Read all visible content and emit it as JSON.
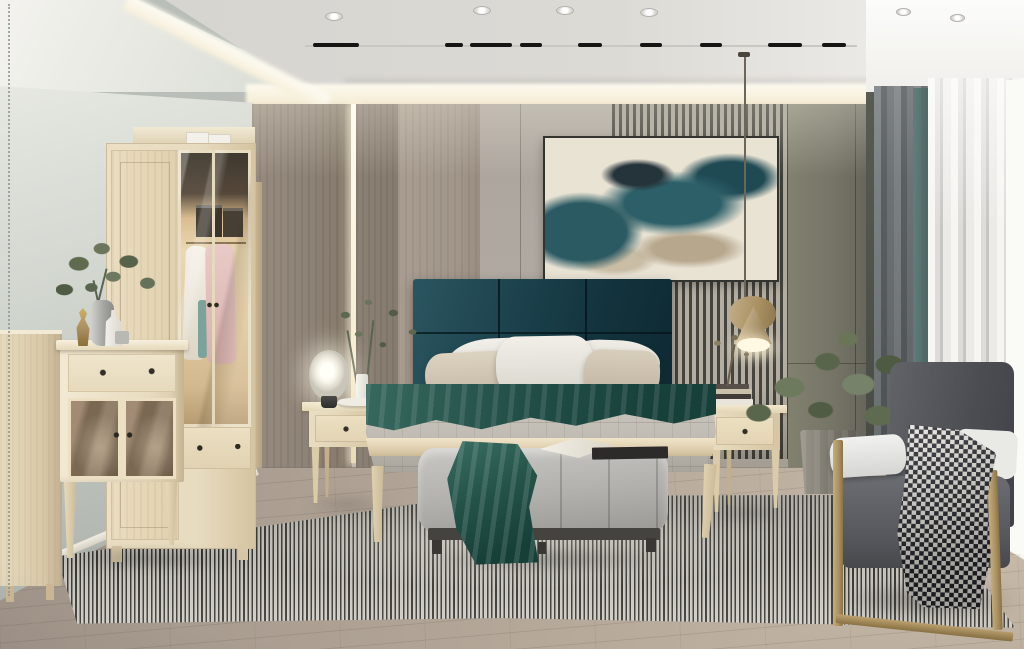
{
  "scene": {
    "type": "photorealistic interior render",
    "room": "bedroom",
    "style": "modern light-wood scandinavian",
    "objects": [
      "wardrobe-with-glass-display",
      "storage-boxes",
      "dresser-with-mirrored-doors",
      "sideboard",
      "plant-vase-decor",
      "upholstered-headboard-panels",
      "double-bed-light-wood",
      "pillows",
      "teal-throw-blanket",
      "nightstand-left",
      "nightstand-right",
      "glass-table-lamp",
      "gold-cone-pendant-lamp",
      "abstract-wall-art",
      "slatted-wall-panel",
      "led-wall-strip",
      "upholstered-bench",
      "open-book",
      "striped-area-rug",
      "gold-frame-armchair",
      "houndstooth-blanket",
      "potted-plant",
      "gray-and-sheer-curtains",
      "cove-lighting",
      "recessed-downlights",
      "track-lighting"
    ]
  },
  "palette": {
    "wallLeft": "#cfd4cd",
    "wallLeftLight": "#f4f3ef",
    "ceiling": "#d6d4cf",
    "cove": "#f6efda",
    "panelWoodDark": "#8d8276",
    "panelWoodMid": "#a1968a",
    "panelGray": "#aaa49c",
    "slatDark": "#45443e",
    "slatLight": "#b3ada1",
    "panelOlive": "#757466",
    "headboardTeal1": "#2b5560",
    "headboardTeal2": "#12323c",
    "artCream": "#e9e3d4",
    "artTeal": "#2b5a63",
    "artDark": "#25333a",
    "artTan": "#b7a78d",
    "woodFurniture": "#e8dcc0",
    "bedding": "#c0bcb4",
    "beddingShadow": "#a8a49c",
    "tealThrow": "#37685e",
    "tealThrowDark": "#18403a",
    "pillowWhite": "#f2f0ea",
    "pillowBeige": "#ddd3c1",
    "benchGray": "#b2b0ac",
    "benchBase": "#45433f",
    "rugLight": "#d3d0c9",
    "rugDark": "#32322e",
    "floorLight": "#b6a99a",
    "floorDark": "#a1958a",
    "chairGray": "#4b4d52",
    "chairSeat": "#54565b",
    "chairPadWhite": "#e9e9e6",
    "gold": "#a98f60",
    "houndsDark": "#24252b",
    "houndsLight": "#e7e4dd",
    "curtainGray": "#5a5f62",
    "curtainTeal": "#4a6865",
    "sheerLight": "#f6f5f2",
    "sheerShade": "#c7c6c2",
    "plantGreen": "#6e7a5e",
    "plantGreenDark": "#505c44",
    "lampGlow": "#fff8e2",
    "metalDark": "#2e2e2c"
  }
}
